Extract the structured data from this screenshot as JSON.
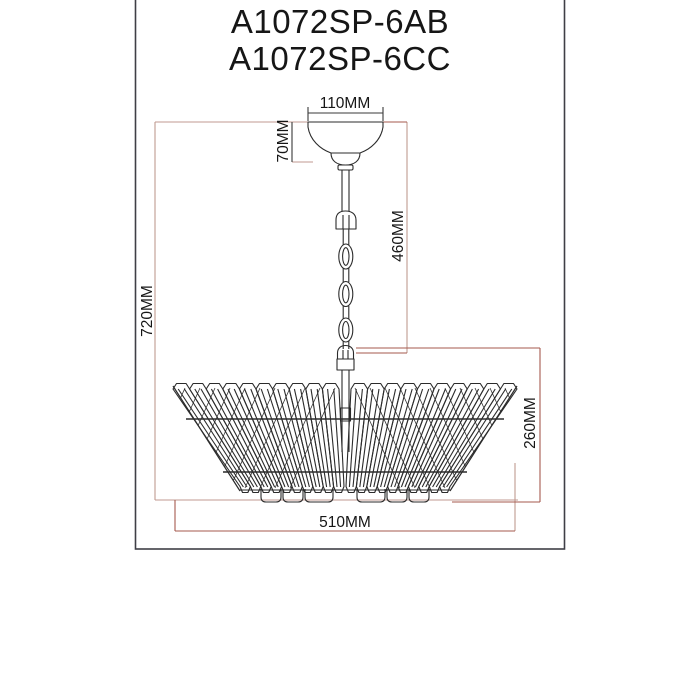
{
  "title": {
    "line1": "A1072SP-6AB",
    "line2": "A1072SP-6CC"
  },
  "dimensions": {
    "canopy_width": "110MM",
    "canopy_height": "70MM",
    "chain_drop": "460MM",
    "overall_height": "720MM",
    "shade_height": "260MM",
    "shade_diameter": "510MM"
  },
  "colors": {
    "fixture_line": "#2b2b2b",
    "dim_light": "#c09a90",
    "dim_dark": "#a55a4e",
    "dim_black": "#3a3a3a",
    "frame": "#3f3f46",
    "text": "#161616"
  }
}
